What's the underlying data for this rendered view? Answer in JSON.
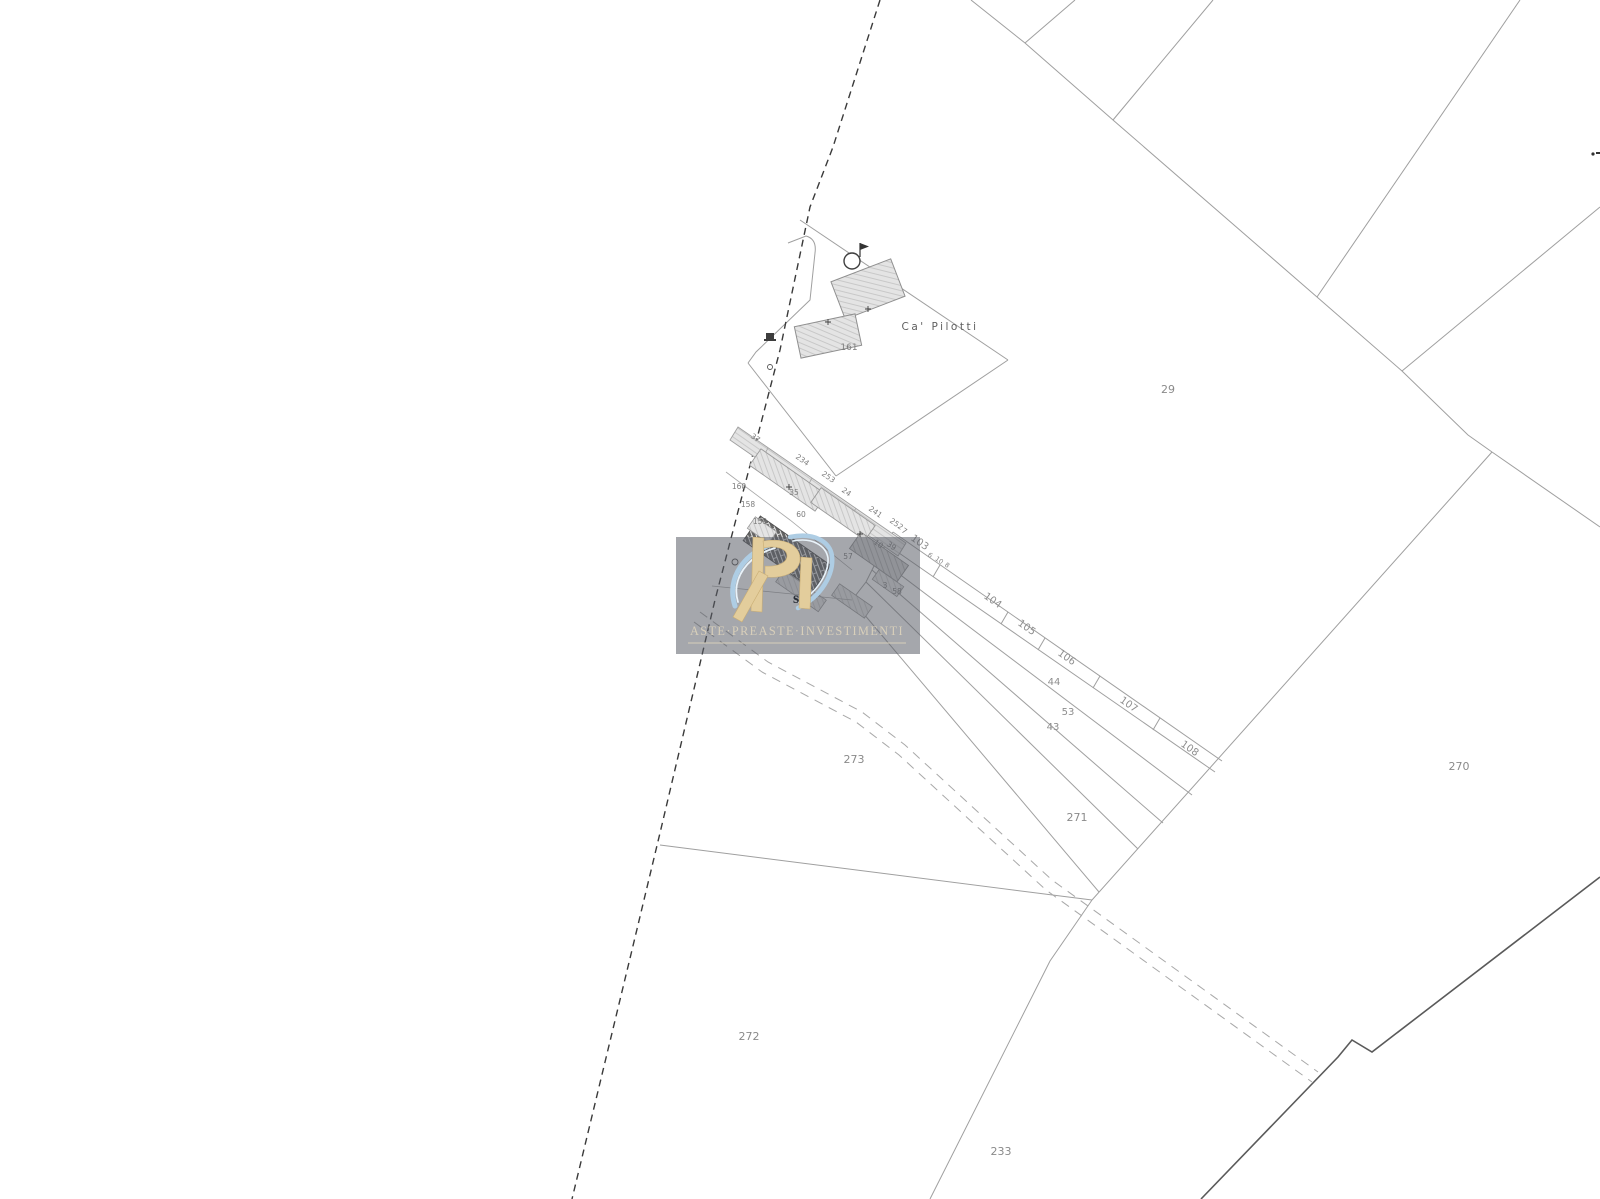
{
  "map": {
    "place_label": "Ca' Pilotti",
    "labels": {
      "p29": "29",
      "p270": "270",
      "p271": "271",
      "p272": "272",
      "p273": "273",
      "p233": "233",
      "s103": "103",
      "s104": "104",
      "s105": "105",
      "s106": "106",
      "s107": "107",
      "s108": "108",
      "r44": "44",
      "r53": "53",
      "r43": "43",
      "b161": "161",
      "c37": "37",
      "c234": "234",
      "c253": "253",
      "c160": "160",
      "c35": "35",
      "c158": "158",
      "c159": "159",
      "c60": "60",
      "c24": "24",
      "c241": "241",
      "c252": "252",
      "c7": "7",
      "c57": "57",
      "c10": "10",
      "c39": "39",
      "c58": "58",
      "c3": "3",
      "c6": "6",
      "c10b": "10",
      "c8": "8"
    }
  },
  "watermark": {
    "brand": "ASTE·PREASTE·INVESTIMENTI",
    "monogram_letter": "s",
    "gold": "#e3cd9c",
    "swoosh_blue": "#aecde4",
    "text_color": "#d8cfba"
  },
  "colors": {
    "line": "#9f9f9f",
    "road": "#3a3a3a",
    "darkline": "#5a5a5a",
    "label": "#8a8a8a"
  }
}
